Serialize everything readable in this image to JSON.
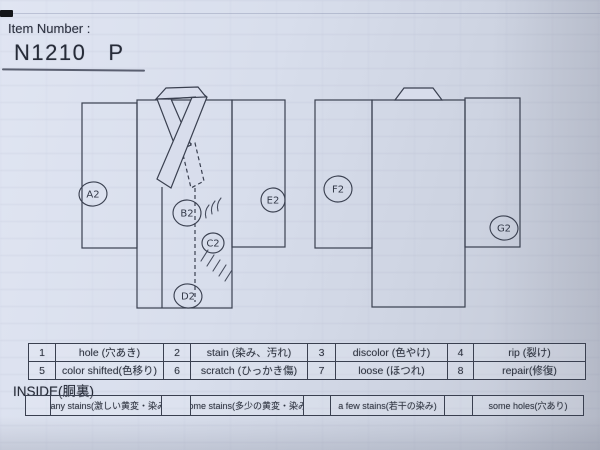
{
  "colors": {
    "ink": "#3a4050",
    "paper": "#d8ddec"
  },
  "header": {
    "label": "Item Number :",
    "item_number": "N1210",
    "item_suffix": "P"
  },
  "diagram": {
    "views": [
      {
        "name": "front"
      },
      {
        "name": "back"
      }
    ],
    "markers": [
      {
        "label": "A2",
        "area": "front-left-sleeve"
      },
      {
        "label": "B2",
        "area": "front-body"
      },
      {
        "label": "C2",
        "area": "front-body"
      },
      {
        "label": "D2",
        "area": "front-hem"
      },
      {
        "label": "E2",
        "area": "front-right-sleeve"
      },
      {
        "label": "F2",
        "area": "back-left-sleeve"
      },
      {
        "label": "G2",
        "area": "back-right-sleeve"
      }
    ]
  },
  "legend": {
    "items": [
      {
        "num": "1",
        "label": "hole (穴あき)"
      },
      {
        "num": "2",
        "label": "stain (染み、汚れ)"
      },
      {
        "num": "3",
        "label": "discolor (色やけ)"
      },
      {
        "num": "4",
        "label": "rip (裂け)"
      },
      {
        "num": "5",
        "label": "color shifted(色移り)"
      },
      {
        "num": "6",
        "label": "scratch (ひっかき傷)"
      },
      {
        "num": "7",
        "label": "loose (ほつれ)"
      },
      {
        "num": "8",
        "label": "repair(修復)"
      }
    ]
  },
  "inside": {
    "heading": "INSIDE(胴裏)",
    "items": [
      {
        "label": "many stains(激しい黄変・染み)"
      },
      {
        "label": "some stains(多少の黄変・染み)"
      },
      {
        "label": "a few stains(若干の染み)"
      },
      {
        "label": "some holes(穴あり)"
      }
    ]
  }
}
